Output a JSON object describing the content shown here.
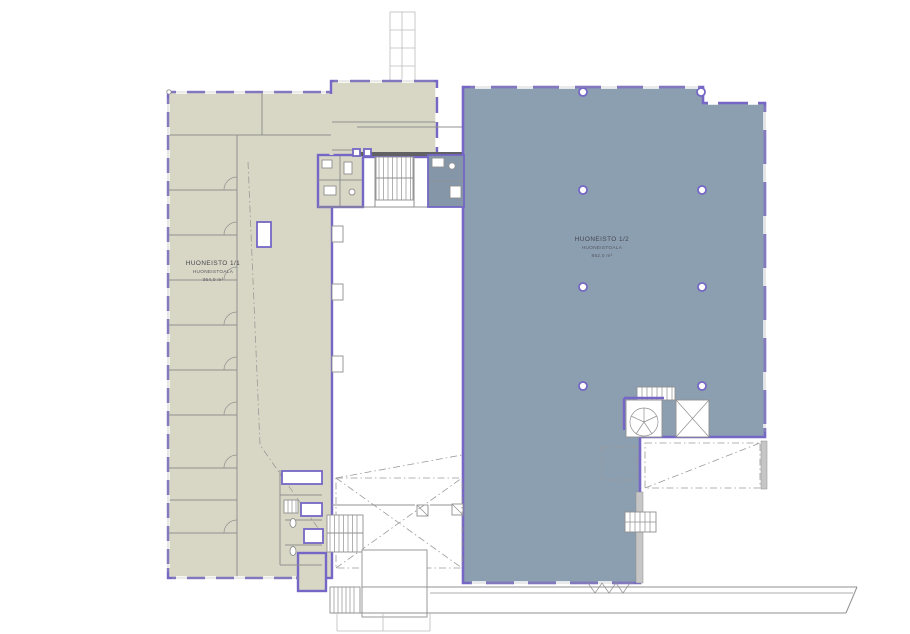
{
  "plan": {
    "units": [
      {
        "name": "HUONEISTO 1/1",
        "area_label": "HUONEISTOALA",
        "area_value": "364,0 m²"
      },
      {
        "name": "HUONEISTO 1/2",
        "area_label": "HUONEISTOALA",
        "area_value": "852,0 m²"
      }
    ]
  },
  "colors": {
    "outline": "#7467c5",
    "unit1": "#d8d7c5",
    "unit2": "#8c9fb1",
    "unit2dark": "#8496a8",
    "wall": "#909090",
    "walldark": "#606065",
    "faint": "#bcbcbc",
    "text": "#45454e",
    "text2": "#55555e"
  }
}
